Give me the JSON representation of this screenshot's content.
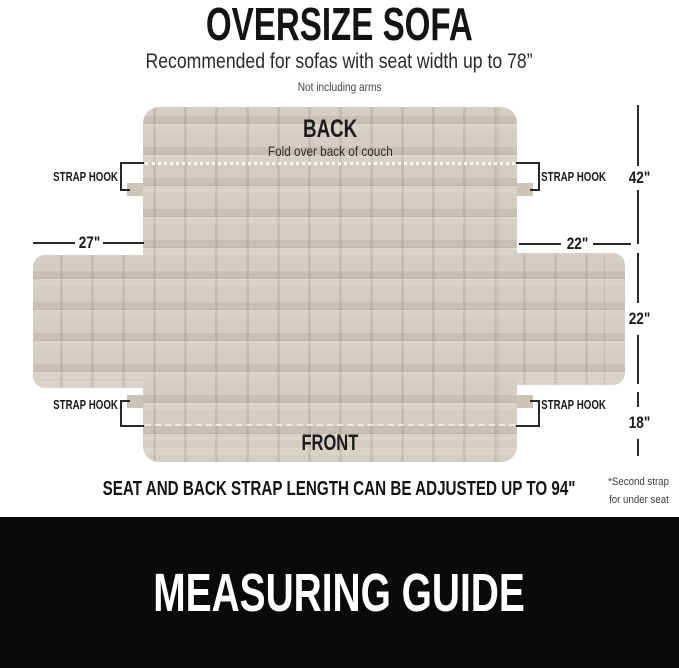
{
  "header": {
    "title": "OVERSIZE SOFA",
    "subtitle": "Recommended for sofas with seat width up to 78”",
    "arms_note": "Not including arms"
  },
  "diagram": {
    "back_label": "BACK",
    "back_caption": "Fold over back of couch",
    "front_label": "FRONT",
    "strap_hook_label": "STRAP HOOK",
    "measurements": {
      "back_height": "42\"",
      "left_arm_width": "27\"",
      "right_arm_width": "22\"",
      "seat_depth": "22\"",
      "front_drop": "18\""
    }
  },
  "notes": {
    "adjust_note": "SEAT AND BACK STRAP LENGTH CAN BE ADJUSTED UP TO 94\"",
    "side_note_line1": "*Second strap",
    "side_note_line2": "for under seat"
  },
  "footer": {
    "title": "MEASURING GUIDE"
  },
  "colors": {
    "fabric": "#d4cdc3",
    "fabric_grid": "#c7bfb4",
    "strap_tab": "#cbc4b8",
    "annotation": "#1a1a1a",
    "footer_bg": "#0a0a0a",
    "footer_text": "#ffffff"
  }
}
